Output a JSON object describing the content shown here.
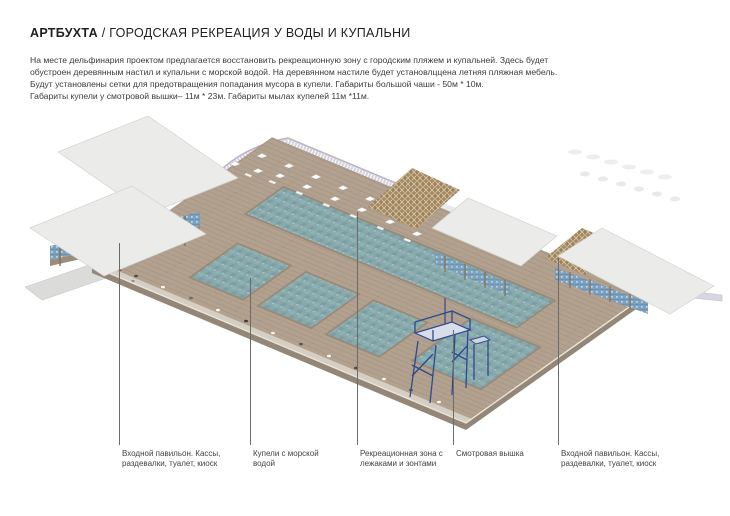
{
  "header": {
    "title_brand": "АРТБУХТА",
    "title_rest": "/ ГОРОДСКАЯ РЕКРЕАЦИЯ У ВОДЫ И КУПАЛЬНИ"
  },
  "description": {
    "lines": [
      "На месте дельфинария проектом предлагается восстановить рекреационную зону с городским пляжем и купальней. Здесь будет",
      "обустроен деревянным настил и купальни с морской водой. На деревянном настиле будет установлццена летняя пляжная мебель.",
      "Будут установлены сетки для предотвращения попадания мусора в купели. Габариты большой чаши - 50м * 10м.",
      "Габариты купели у смотровой вышки– 11м * 23м. Габариты мылах купелей 11м *11м."
    ]
  },
  "callouts": [
    {
      "label": "Входной павильон. Кассы, раздевалки, туалет, киоск"
    },
    {
      "label": "Купели с морской водой"
    },
    {
      "label": "Рекреационная зона с лежаками и зонтами"
    },
    {
      "label": "Смотровая вышка"
    },
    {
      "label": "Входной павильон. Кассы, раздевалки, туалет, киоск"
    }
  ],
  "illustration": {
    "caption": "Аксонометрия деревянного настила с купальнями у воды",
    "colors": {
      "deck": "#b1a18e",
      "water": "#87a9ac",
      "roof": "#ebebe9",
      "pergola": "#a5895f",
      "tower": "#2e4a8f",
      "balustrade": "#d6d3de",
      "ramp": "#dbdbd9",
      "blue_wall": "#7aa2c0"
    }
  }
}
